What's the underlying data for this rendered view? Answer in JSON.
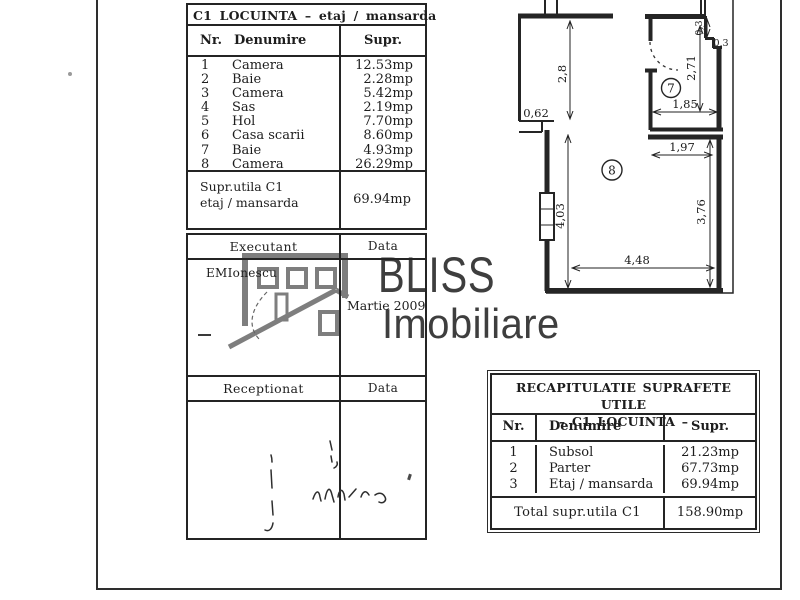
{
  "colors": {
    "ink": "#242424",
    "paper": "#ffffff",
    "logo_gray": "#7e7e7e",
    "logo_text": "#3e3e3e"
  },
  "room_table": {
    "title": "C1 LOCUINTA – etaj / mansarda",
    "headers": {
      "nr": "Nr.",
      "name": "Denumire",
      "area": "Supr."
    },
    "rows": [
      {
        "nr": "1",
        "name": "Camera",
        "area": "12.53mp"
      },
      {
        "nr": "2",
        "name": "Baie",
        "area": "2.28mp"
      },
      {
        "nr": "3",
        "name": "Camera",
        "area": "5.42mp"
      },
      {
        "nr": "4",
        "name": "Sas",
        "area": "2.19mp"
      },
      {
        "nr": "5",
        "name": "Hol",
        "area": "7.70mp"
      },
      {
        "nr": "6",
        "name": "Casa scarii",
        "area": "8.60mp"
      },
      {
        "nr": "7",
        "name": "Baie",
        "area": "4.93mp"
      },
      {
        "nr": "8",
        "name": "Camera",
        "area": "26.29mp"
      }
    ],
    "subtotal": {
      "label_line1": "Supr.utila C1",
      "label_line2": "etaj / mansarda",
      "area": "69.94mp"
    }
  },
  "sign_block": {
    "executant_label": "Executant",
    "executant_data_label": "Data",
    "executant_name": "EMIonescu",
    "executant_date": "Martie 2009",
    "receptionat_label": "Receptionat",
    "receptionat_data_label": "Data"
  },
  "recap_table": {
    "title_line1": "RECAPITULATIE SUPRAFETE UTILE",
    "title_line2": "–  C1 LOCUINTA  –",
    "headers": {
      "nr": "Nr.",
      "name": "Denumire",
      "area": "Supr."
    },
    "rows": [
      {
        "nr": "1",
        "name": "Subsol",
        "area": "21.23mp"
      },
      {
        "nr": "2",
        "name": "Parter",
        "area": "67.73mp"
      },
      {
        "nr": "3",
        "name": "Etaj / mansarda",
        "area": "69.94mp"
      }
    ],
    "total": {
      "label": "Total supr.utila C1",
      "area": "158.90mp"
    }
  },
  "floor_plan": {
    "room_labels": {
      "room7": "7",
      "room8": "8"
    },
    "dims": {
      "d28": "2,8",
      "d062": "0,62",
      "d403": "4,03",
      "d448": "4,48",
      "d185": "1,85",
      "d271": "2,71",
      "d03v": "0,3",
      "d03h": "0,3",
      "d197": "1,97",
      "d376": "3,76"
    }
  },
  "watermark": {
    "line1": "BLISS",
    "line2": "Imobiliare"
  }
}
